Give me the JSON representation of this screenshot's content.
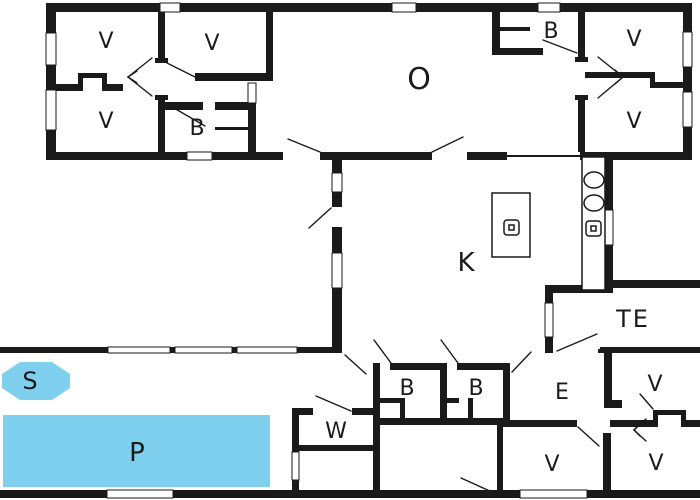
{
  "title": "house-floor-plan",
  "colors": {
    "background": "#ffffff",
    "walls": "#1a1a1a",
    "pool": "#7fd0ee",
    "label": "#1b1b1b",
    "pool_label": "#17305a"
  },
  "rooms": {
    "bedroom_nw": "V",
    "bedroom_n": "V",
    "bedroom_sw": "V",
    "bath_west": "B",
    "living": "O",
    "bath_ne": "B",
    "bedroom_ne": "V",
    "bedroom_e": "V",
    "kitchen": "K",
    "terrace": "TE",
    "bath_s1": "B",
    "bath_s2": "B",
    "entry": "E",
    "utility": "W",
    "spa": "S",
    "pool": "P",
    "bedroom_s_center": "V",
    "bedroom_se_top": "V",
    "bedroom_se_bottom": "V"
  },
  "icons": {
    "sink": "oval-basin",
    "cooktop": "rounded-square-burner",
    "island": "kitchen-island",
    "counter": "kitchen-counter"
  }
}
